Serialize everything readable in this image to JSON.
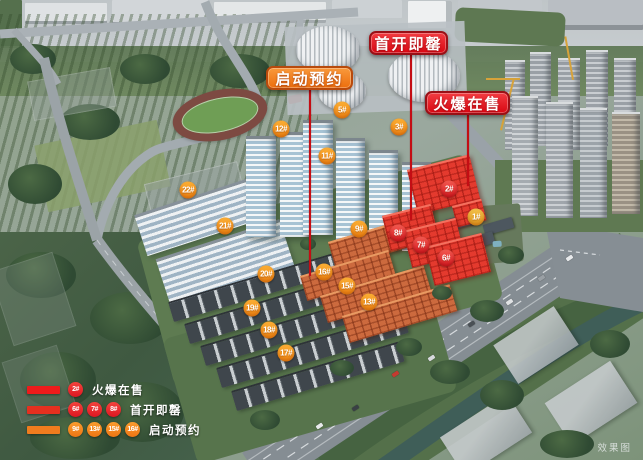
{
  "callouts": [
    {
      "label": "首开即罄",
      "style": "red",
      "x": 369,
      "y": 31,
      "w": 79,
      "h": 24,
      "line_x": 411,
      "line_y1": 55,
      "line_y2": 220
    },
    {
      "label": "启动预约",
      "style": "orange",
      "x": 266,
      "y": 66,
      "w": 87,
      "h": 24,
      "line_x": 310,
      "line_y1": 90,
      "line_y2": 276
    },
    {
      "label": "火爆在售",
      "style": "red",
      "x": 425,
      "y": 91,
      "w": 85,
      "h": 24,
      "line_x": 468,
      "line_y1": 115,
      "line_y2": 186
    }
  ],
  "building_badges": [
    {
      "label": "5#",
      "x": 342,
      "y": 110,
      "color": "orange"
    },
    {
      "label": "12#",
      "x": 281,
      "y": 129,
      "color": "orange"
    },
    {
      "label": "3#",
      "x": 399,
      "y": 127,
      "color": "orange"
    },
    {
      "label": "11#",
      "x": 327,
      "y": 156,
      "color": "orange"
    },
    {
      "label": "22#",
      "x": 188,
      "y": 190,
      "color": "orange"
    },
    {
      "label": "2#",
      "x": 449,
      "y": 189,
      "color": "red"
    },
    {
      "label": "1#",
      "x": 476,
      "y": 217,
      "color": "gold"
    },
    {
      "label": "21#",
      "x": 225,
      "y": 226,
      "color": "orange"
    },
    {
      "label": "9#",
      "x": 359,
      "y": 229,
      "color": "orange"
    },
    {
      "label": "8#",
      "x": 398,
      "y": 233,
      "color": "red"
    },
    {
      "label": "7#",
      "x": 421,
      "y": 245,
      "color": "red"
    },
    {
      "label": "6#",
      "x": 446,
      "y": 258,
      "color": "red"
    },
    {
      "label": "20#",
      "x": 266,
      "y": 274,
      "color": "orange"
    },
    {
      "label": "16#",
      "x": 324,
      "y": 272,
      "color": "orange"
    },
    {
      "label": "15#",
      "x": 347,
      "y": 286,
      "color": "orange"
    },
    {
      "label": "13#",
      "x": 369,
      "y": 302,
      "color": "orange"
    },
    {
      "label": "19#",
      "x": 252,
      "y": 308,
      "color": "orange"
    },
    {
      "label": "18#",
      "x": 269,
      "y": 330,
      "color": "orange"
    },
    {
      "label": "17#",
      "x": 286,
      "y": 353,
      "color": "orange"
    }
  ],
  "legend": {
    "rows": [
      {
        "label": "火爆在售",
        "bar": "#ee1b1b",
        "badge_style": "red",
        "badges": [
          "2#"
        ]
      },
      {
        "label": "首开即罄",
        "bar": "#e5301f",
        "badge_style": "red",
        "badges": [
          "6#",
          "7#",
          "8#"
        ]
      },
      {
        "label": "启动预约",
        "bar": "#f07c1e",
        "badge_style": "orange",
        "badges": [
          "9#",
          "13#",
          "15#",
          "16#"
        ]
      }
    ]
  },
  "watermark": "效果图",
  "colors": {
    "callout_red": "#d90712",
    "callout_red_border": "#9a1016",
    "callout_orange": "#ec6e0d",
    "callout_orange_border": "#b84a0c",
    "badge_orange": "#ee8312",
    "badge_red": "#d91a22",
    "badge_gold": "#e0961d",
    "leader_line": "#c40d14",
    "sold_building": "#e43a2e",
    "reserve_building": "#cc6a3e"
  }
}
